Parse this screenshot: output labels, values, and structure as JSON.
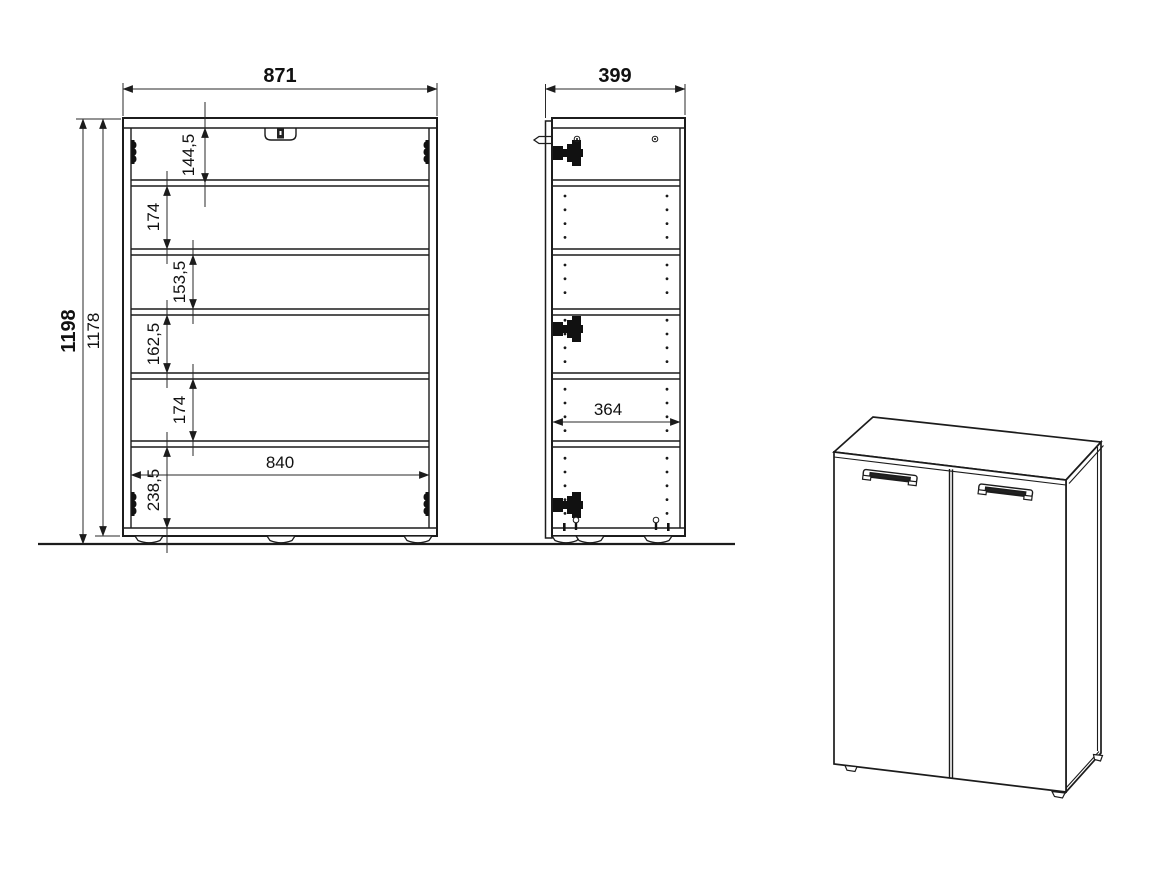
{
  "document": {
    "kind": "furniture technical drawing",
    "views": 3
  },
  "colors": {
    "line": "#1c1c1c",
    "background": "#ffffff",
    "text": "#111111"
  },
  "dims": {
    "front_width": "871",
    "front_height_total": "1198",
    "front_height_body": "1178",
    "front_inner_width": "840",
    "front_gap_top": "144,5",
    "front_gap_2": "174",
    "front_gap_3": "153,5",
    "front_gap_4": "162,5",
    "front_gap_5": "174",
    "front_gap_bottom": "238,5",
    "side_depth": "399",
    "side_inner_depth": "364"
  }
}
